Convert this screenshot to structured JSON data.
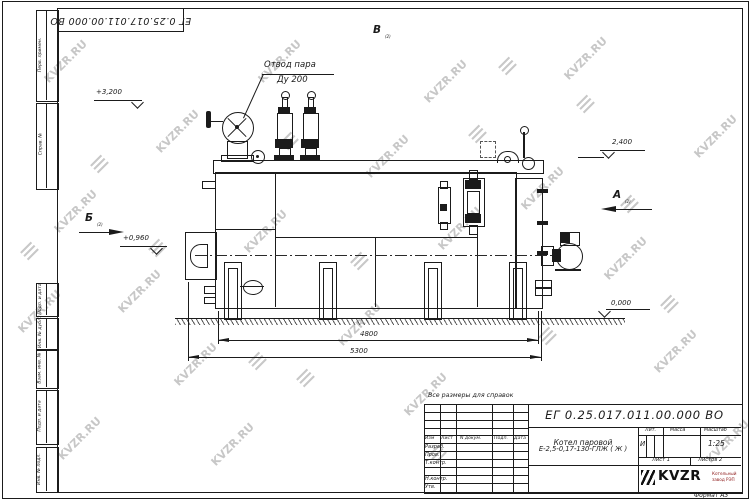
{
  "watermark": {
    "text": "KVZR.RU"
  },
  "frame": {
    "doc_number_top": "ЕГ 0.25.017.011.00.000  ВО",
    "format_note": "Формат А3",
    "side_labels": [
      "Перв. примен.",
      "Справ. №",
      "Подп. и дата",
      "Инв. № дубл.",
      "Взам. инв. №",
      "Подп. и дата",
      "Инв. № подл."
    ]
  },
  "drawing": {
    "note": "Все размеры для справок",
    "steam_label_line1": "Отвод пара",
    "steam_label_line2": "Ду 200",
    "elevations": {
      "top_left": "+3,200",
      "mid_left": "+0,960",
      "right": "2,400",
      "ground": "0,000"
    },
    "dimensions": {
      "inner": "4800",
      "overall": "5300"
    },
    "views": {
      "a": "А",
      "b": "Б",
      "v": "В",
      "sheet_ref": "(2)"
    }
  },
  "title_block": {
    "doc_number": "ЕГ 0.25.017.011.00.000  ВО",
    "product_name_line1": "Котел паровой",
    "product_name_line2": "Е-2,5-0,17-130-ГЛЖ ( Ж )",
    "columns": [
      "Изм",
      "Лист",
      "N докум.",
      "Подп.",
      "Дата"
    ],
    "rows": [
      "Разраб.",
      "Пров.",
      "Т.контр.",
      "Н.контр.",
      "Утв."
    ],
    "lit_header": "Лит.",
    "mass_header": "Масса",
    "scale_header": "Масштаб",
    "lit_value": "И",
    "scale_value": "1:25",
    "sheet_label": "Лист 1",
    "sheets_label": "Листов 2",
    "logo_text": "KVZR",
    "logo_caption_line1": "Котельный",
    "logo_caption_line2": "завод РЭП"
  }
}
